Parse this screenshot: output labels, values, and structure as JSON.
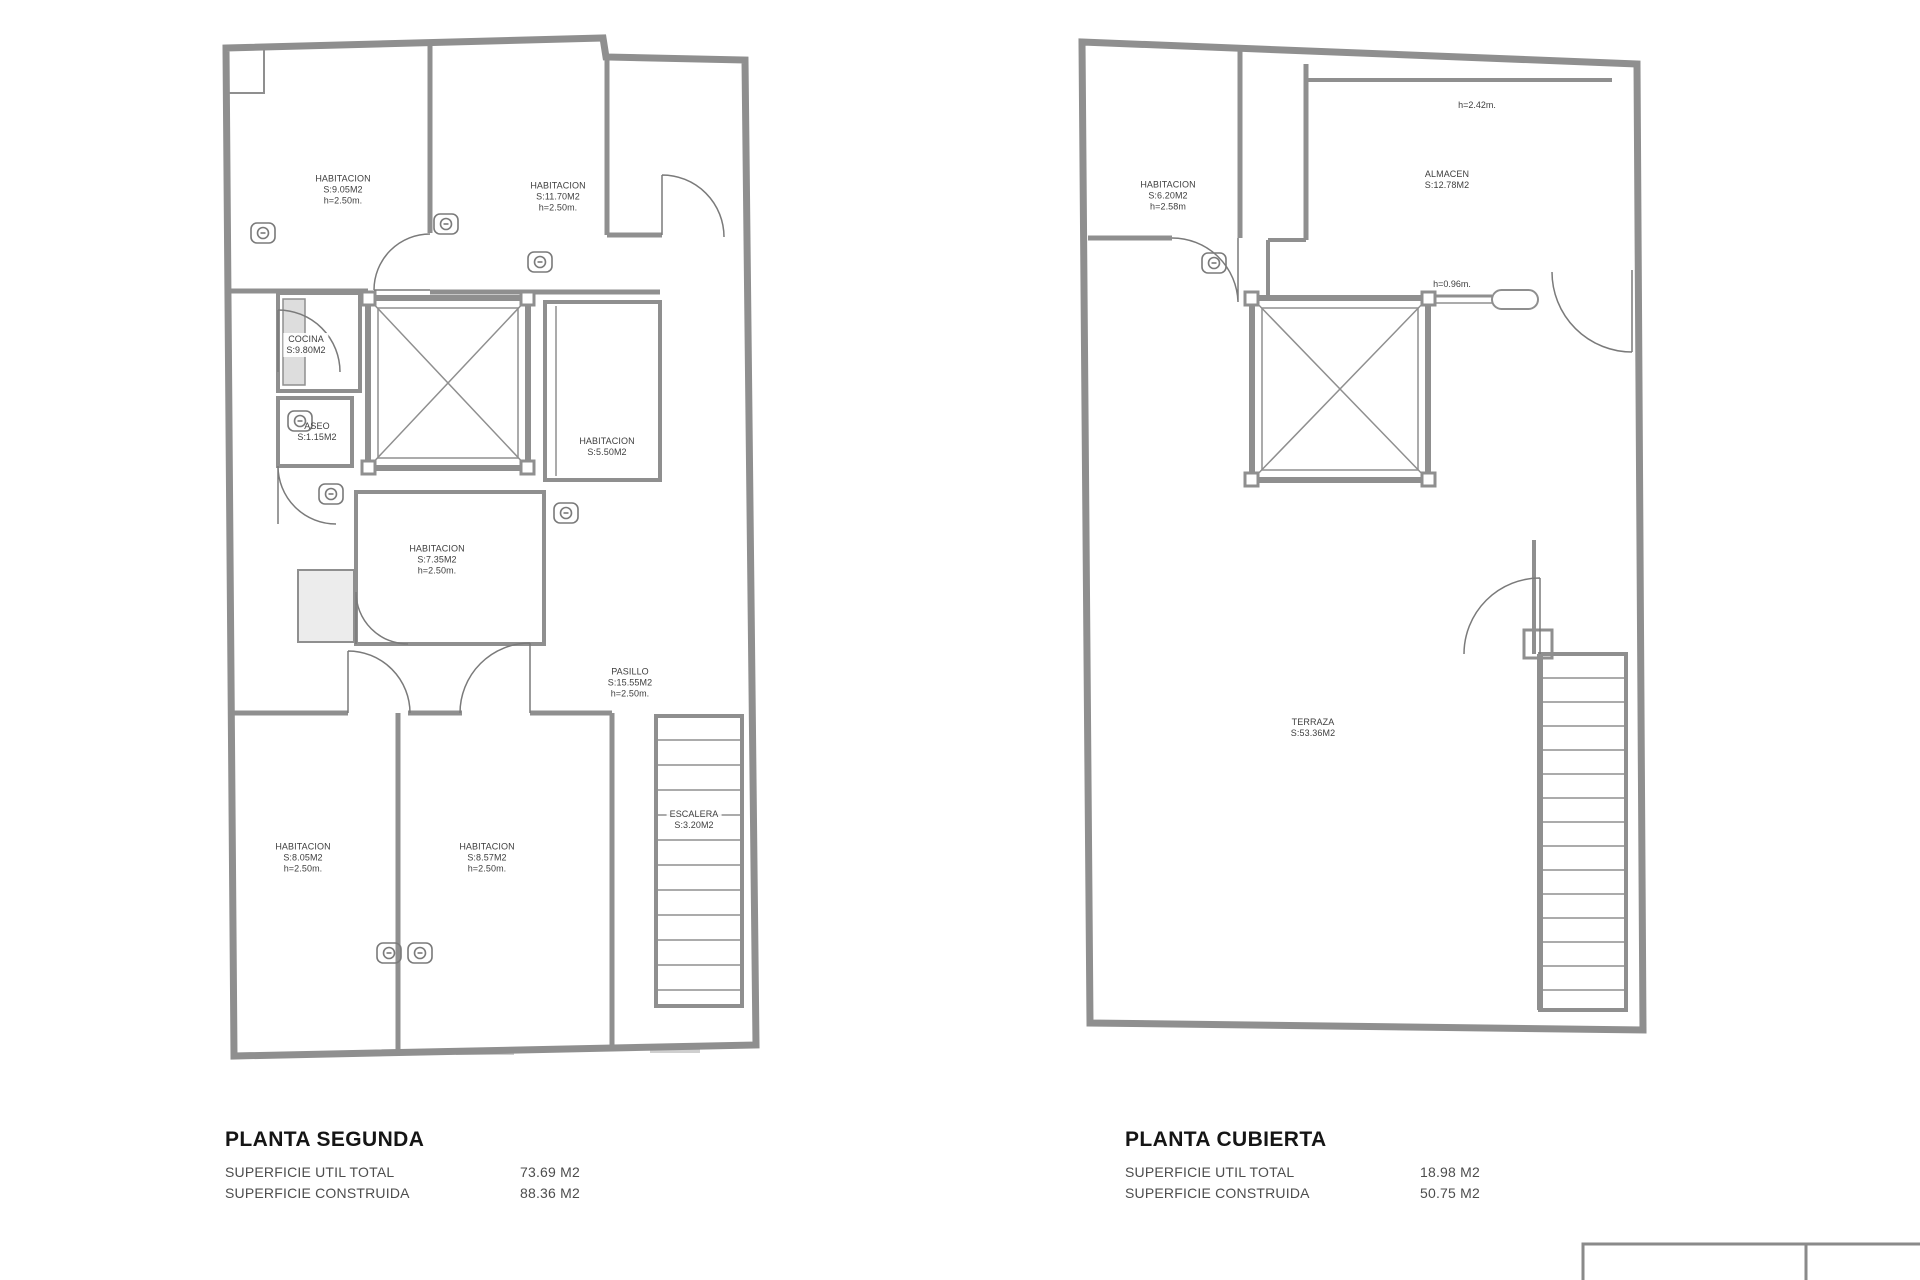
{
  "colors": {
    "wall": "#8f8f8f",
    "thin_line": "#7a7a7a",
    "shading": "#cfcfcf",
    "text": "#3e3e3e",
    "title_text": "#151515"
  },
  "symbols": {
    "fixture_icon": "wall-fixture",
    "elevator_shaft": "crossed-shaft",
    "door_arc": "door-swing",
    "stair_treads": "staircase"
  },
  "plans": {
    "segunda": {
      "title": "PLANTA SEGUNDA",
      "stats": [
        {
          "label": "SUPERFICIE UTIL TOTAL",
          "value": "73.69 M2"
        },
        {
          "label": "SUPERFICIE CONSTRUIDA",
          "value": "88.36 M2"
        }
      ],
      "rooms": [
        {
          "name": "HABITACION",
          "area": "S:9.05M2",
          "height": "h=2.50m."
        },
        {
          "name": "HABITACION",
          "area": "S:11.70M2",
          "height": "h=2.50m."
        },
        {
          "name": "COCINA",
          "area": "S:9.80M2"
        },
        {
          "name": "ASEO",
          "area": "S:1.15M2"
        },
        {
          "name": "HABITACION",
          "area": "S:5.50M2"
        },
        {
          "name": "HABITACION",
          "area": "S:7.35M2",
          "height": "h=2.50m."
        },
        {
          "name": "PASILLO",
          "area": "S:15.55M2",
          "height": "h=2.50m."
        },
        {
          "name": "ESCALERA",
          "area": "S:3.20M2"
        },
        {
          "name": "HABITACION",
          "area": "S:8.05M2",
          "height": "h=2.50m."
        },
        {
          "name": "HABITACION",
          "area": "S:8.57M2",
          "height": "h=2.50m."
        }
      ]
    },
    "cubierta": {
      "title": "PLANTA CUBIERTA",
      "stats": [
        {
          "label": "SUPERFICIE UTIL TOTAL",
          "value": "18.98 M2"
        },
        {
          "label": "SUPERFICIE CONSTRUIDA",
          "value": "50.75 M2"
        }
      ],
      "rooms": [
        {
          "name": "HABITACION",
          "area": "S:6.20M2",
          "height": "h=2.58m"
        },
        {
          "name": "ALMACEN",
          "area": "S:12.78M2"
        },
        {
          "name": "TERRAZA",
          "area": "S:53.36M2"
        }
      ],
      "annotations": [
        {
          "text": "h=2.42m."
        },
        {
          "text": "h=0.96m."
        }
      ]
    }
  }
}
